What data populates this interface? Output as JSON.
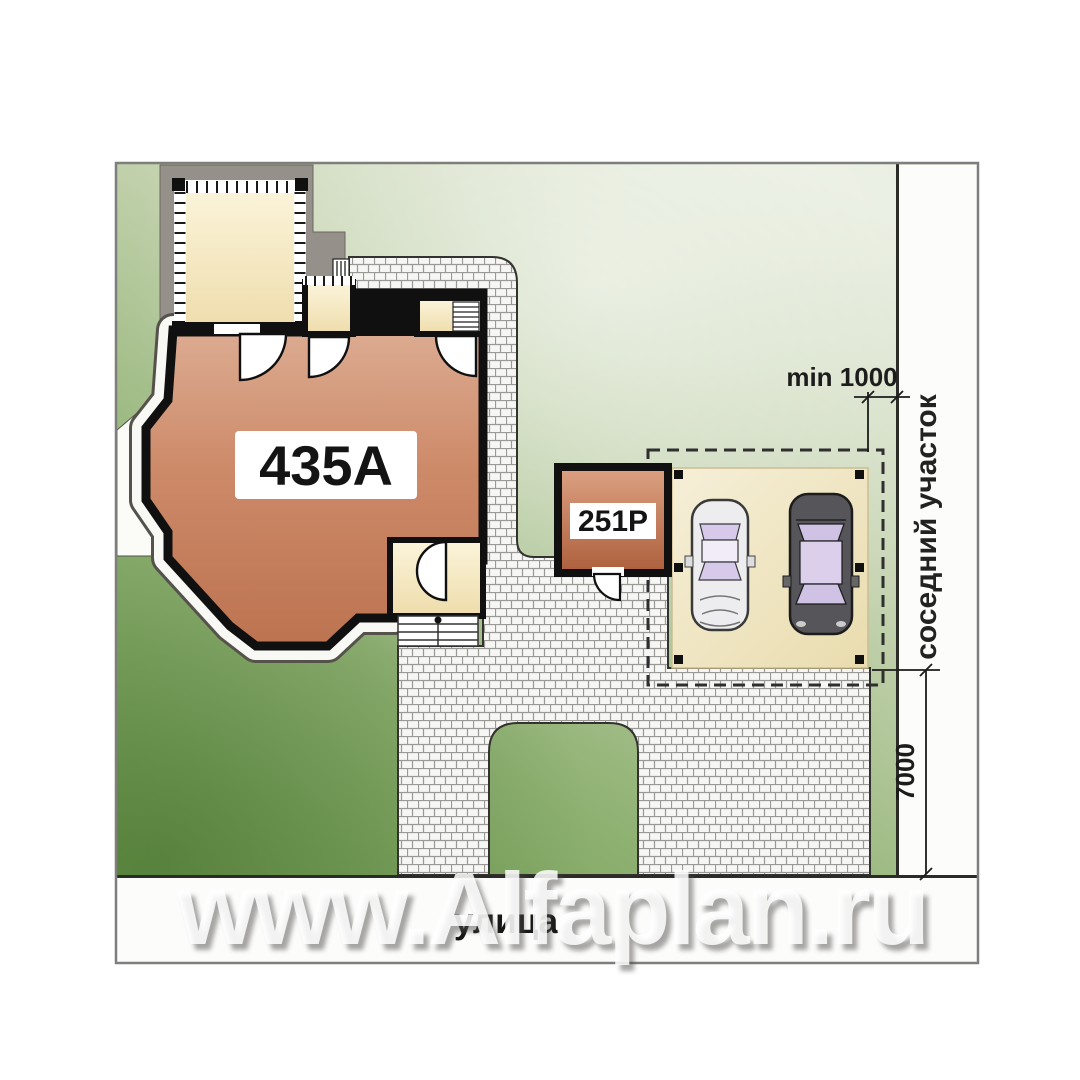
{
  "plan": {
    "house": {
      "label": "435A"
    },
    "garage": {
      "label": "251P"
    },
    "dimensions": {
      "min_setback": "min 1000",
      "side_depth": "7000"
    },
    "areas": {
      "neighbor_plot": "соседний участок",
      "street": "улица"
    },
    "watermark": "www.Alfaplan.ru",
    "colors": {
      "lawn_light": "#e4eadb",
      "lawn_mid": "#9ab877",
      "lawn_dark": "#6f9a50",
      "paving_base": "#f6f6f4",
      "paving_joint": "#9a9995",
      "house_fill_top": "#e0b49c",
      "house_fill_bottom": "#bc7350",
      "garage_fill_top": "#dca283",
      "garage_fill_bottom": "#ad5f3c",
      "room_cream": "#f7edc9",
      "terrace_gray": "#95918a",
      "parking_pad": "#f0e6c4",
      "wall_black": "#101010",
      "boundary_line": "#2b2b28",
      "glass_lavender": "#d6c9ea",
      "car_light_body": "#ededef",
      "car_dark_body": "#55555a"
    }
  }
}
